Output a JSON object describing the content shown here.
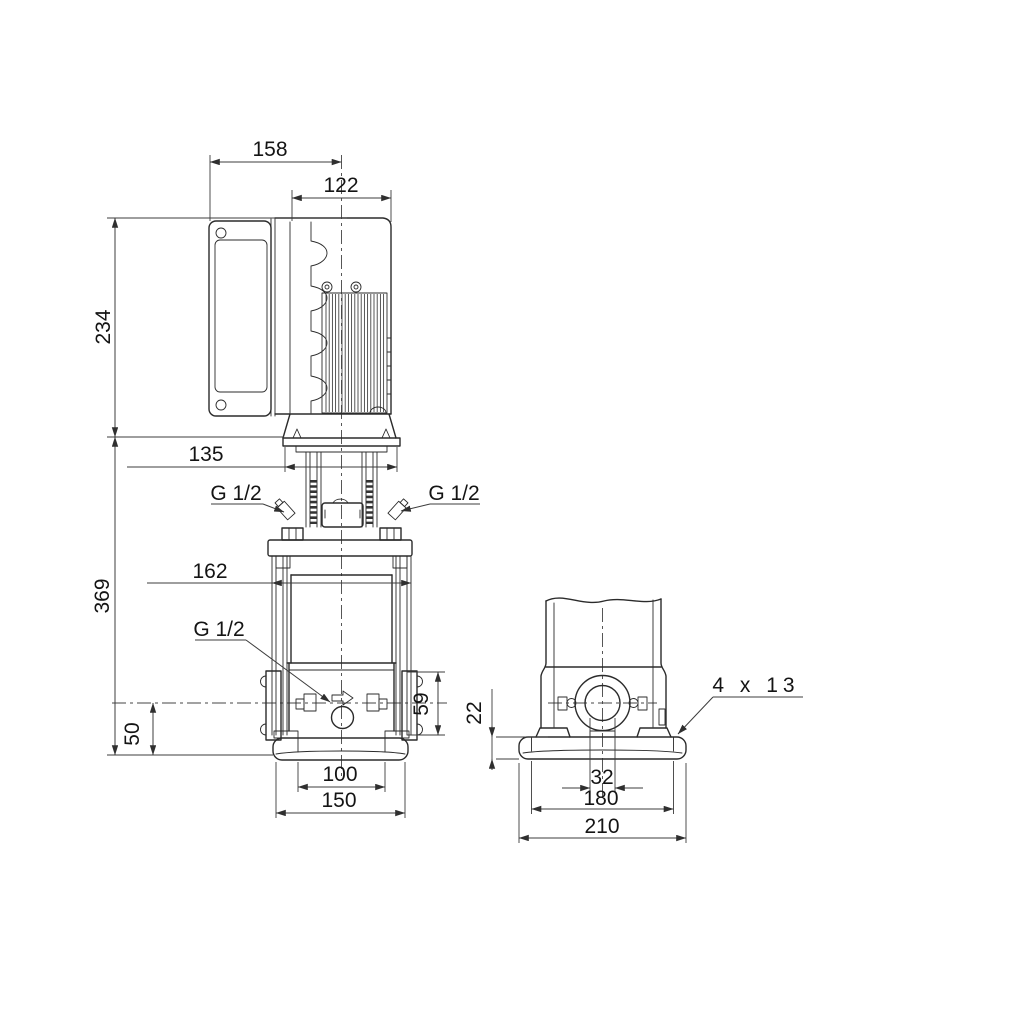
{
  "drawing": {
    "front_view": {
      "dim_overall_width": "158",
      "dim_motor_width": "122",
      "dim_motor_height": "234",
      "dim_motor_flange_width": "135",
      "label_plug_left": "G 1/2",
      "label_plug_right": "G 1/2",
      "dim_staybolt_width": "162",
      "label_drain_plug": "G 1/2",
      "dim_pump_height": "369",
      "dim_port_flange_height": "59",
      "dim_port_centerline_height": "50",
      "dim_foot_spacing": "100",
      "dim_base_width": "150"
    },
    "side_view": {
      "dim_base_plate_height": "22",
      "dim_port_bore": "32",
      "dim_bolt_hole_spacing": "180",
      "dim_base_plate_depth": "210",
      "label_bolt_holes": "4 x 13"
    }
  }
}
